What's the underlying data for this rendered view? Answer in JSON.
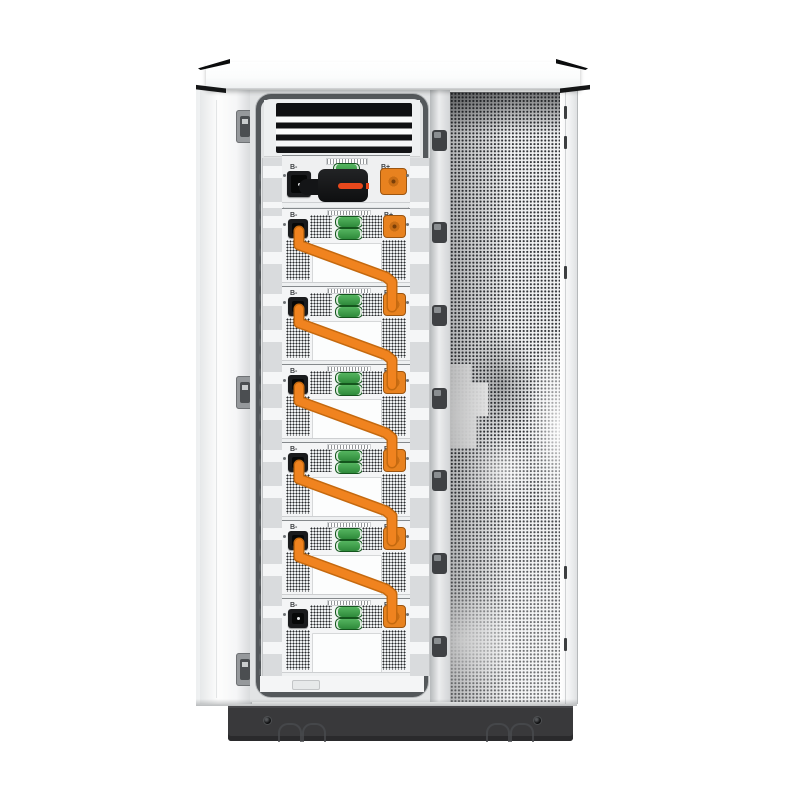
{
  "scene": {
    "type": "product-photo",
    "subject": "Outdoor battery energy storage cabinet, front view with left door open showing a rack of stacked battery modules chained together with orange power cables; closed right door is a perforated ventilation panel",
    "background": "#ffffff"
  },
  "palette": {
    "cabinet_white": "#fbfcfc",
    "bay_gasket_gray": "#54585b",
    "base_dark": "#39393b",
    "cable_orange": "#f0831f",
    "cable_orange_shadow": "#c4690f",
    "connector_orange": "#e8821f",
    "connector_green": "#3f9c4c",
    "connector_black": "#1a1b1d",
    "breaker_red": "#e8481c"
  },
  "cabinet": {
    "top_cap": {
      "corner_accents": 4
    },
    "left_door": {
      "state": "open",
      "hinge_count": 3
    },
    "divider_hinge_count": 7,
    "right_door": {
      "type": "perforated-mesh"
    },
    "switch_unit": {
      "neg_label": "B-",
      "pos_label": "B+",
      "has_breaker": true
    },
    "modules": [
      {
        "id": 1,
        "neg_label": "B-",
        "pos_label": "B+"
      },
      {
        "id": 2,
        "neg_label": "B-",
        "pos_label": "B+"
      },
      {
        "id": 3,
        "neg_label": "B-",
        "pos_label": "B+"
      },
      {
        "id": 4,
        "neg_label": "B-",
        "pos_label": "B+"
      },
      {
        "id": 5,
        "neg_label": "B-",
        "pos_label": "B+"
      },
      {
        "id": 6,
        "neg_label": "B-",
        "pos_label": "B+"
      }
    ],
    "cables": {
      "count": 5,
      "color": "#f0831f"
    },
    "base": {
      "screw_count": 2,
      "fork_slot_arch_pairs": 2
    }
  }
}
